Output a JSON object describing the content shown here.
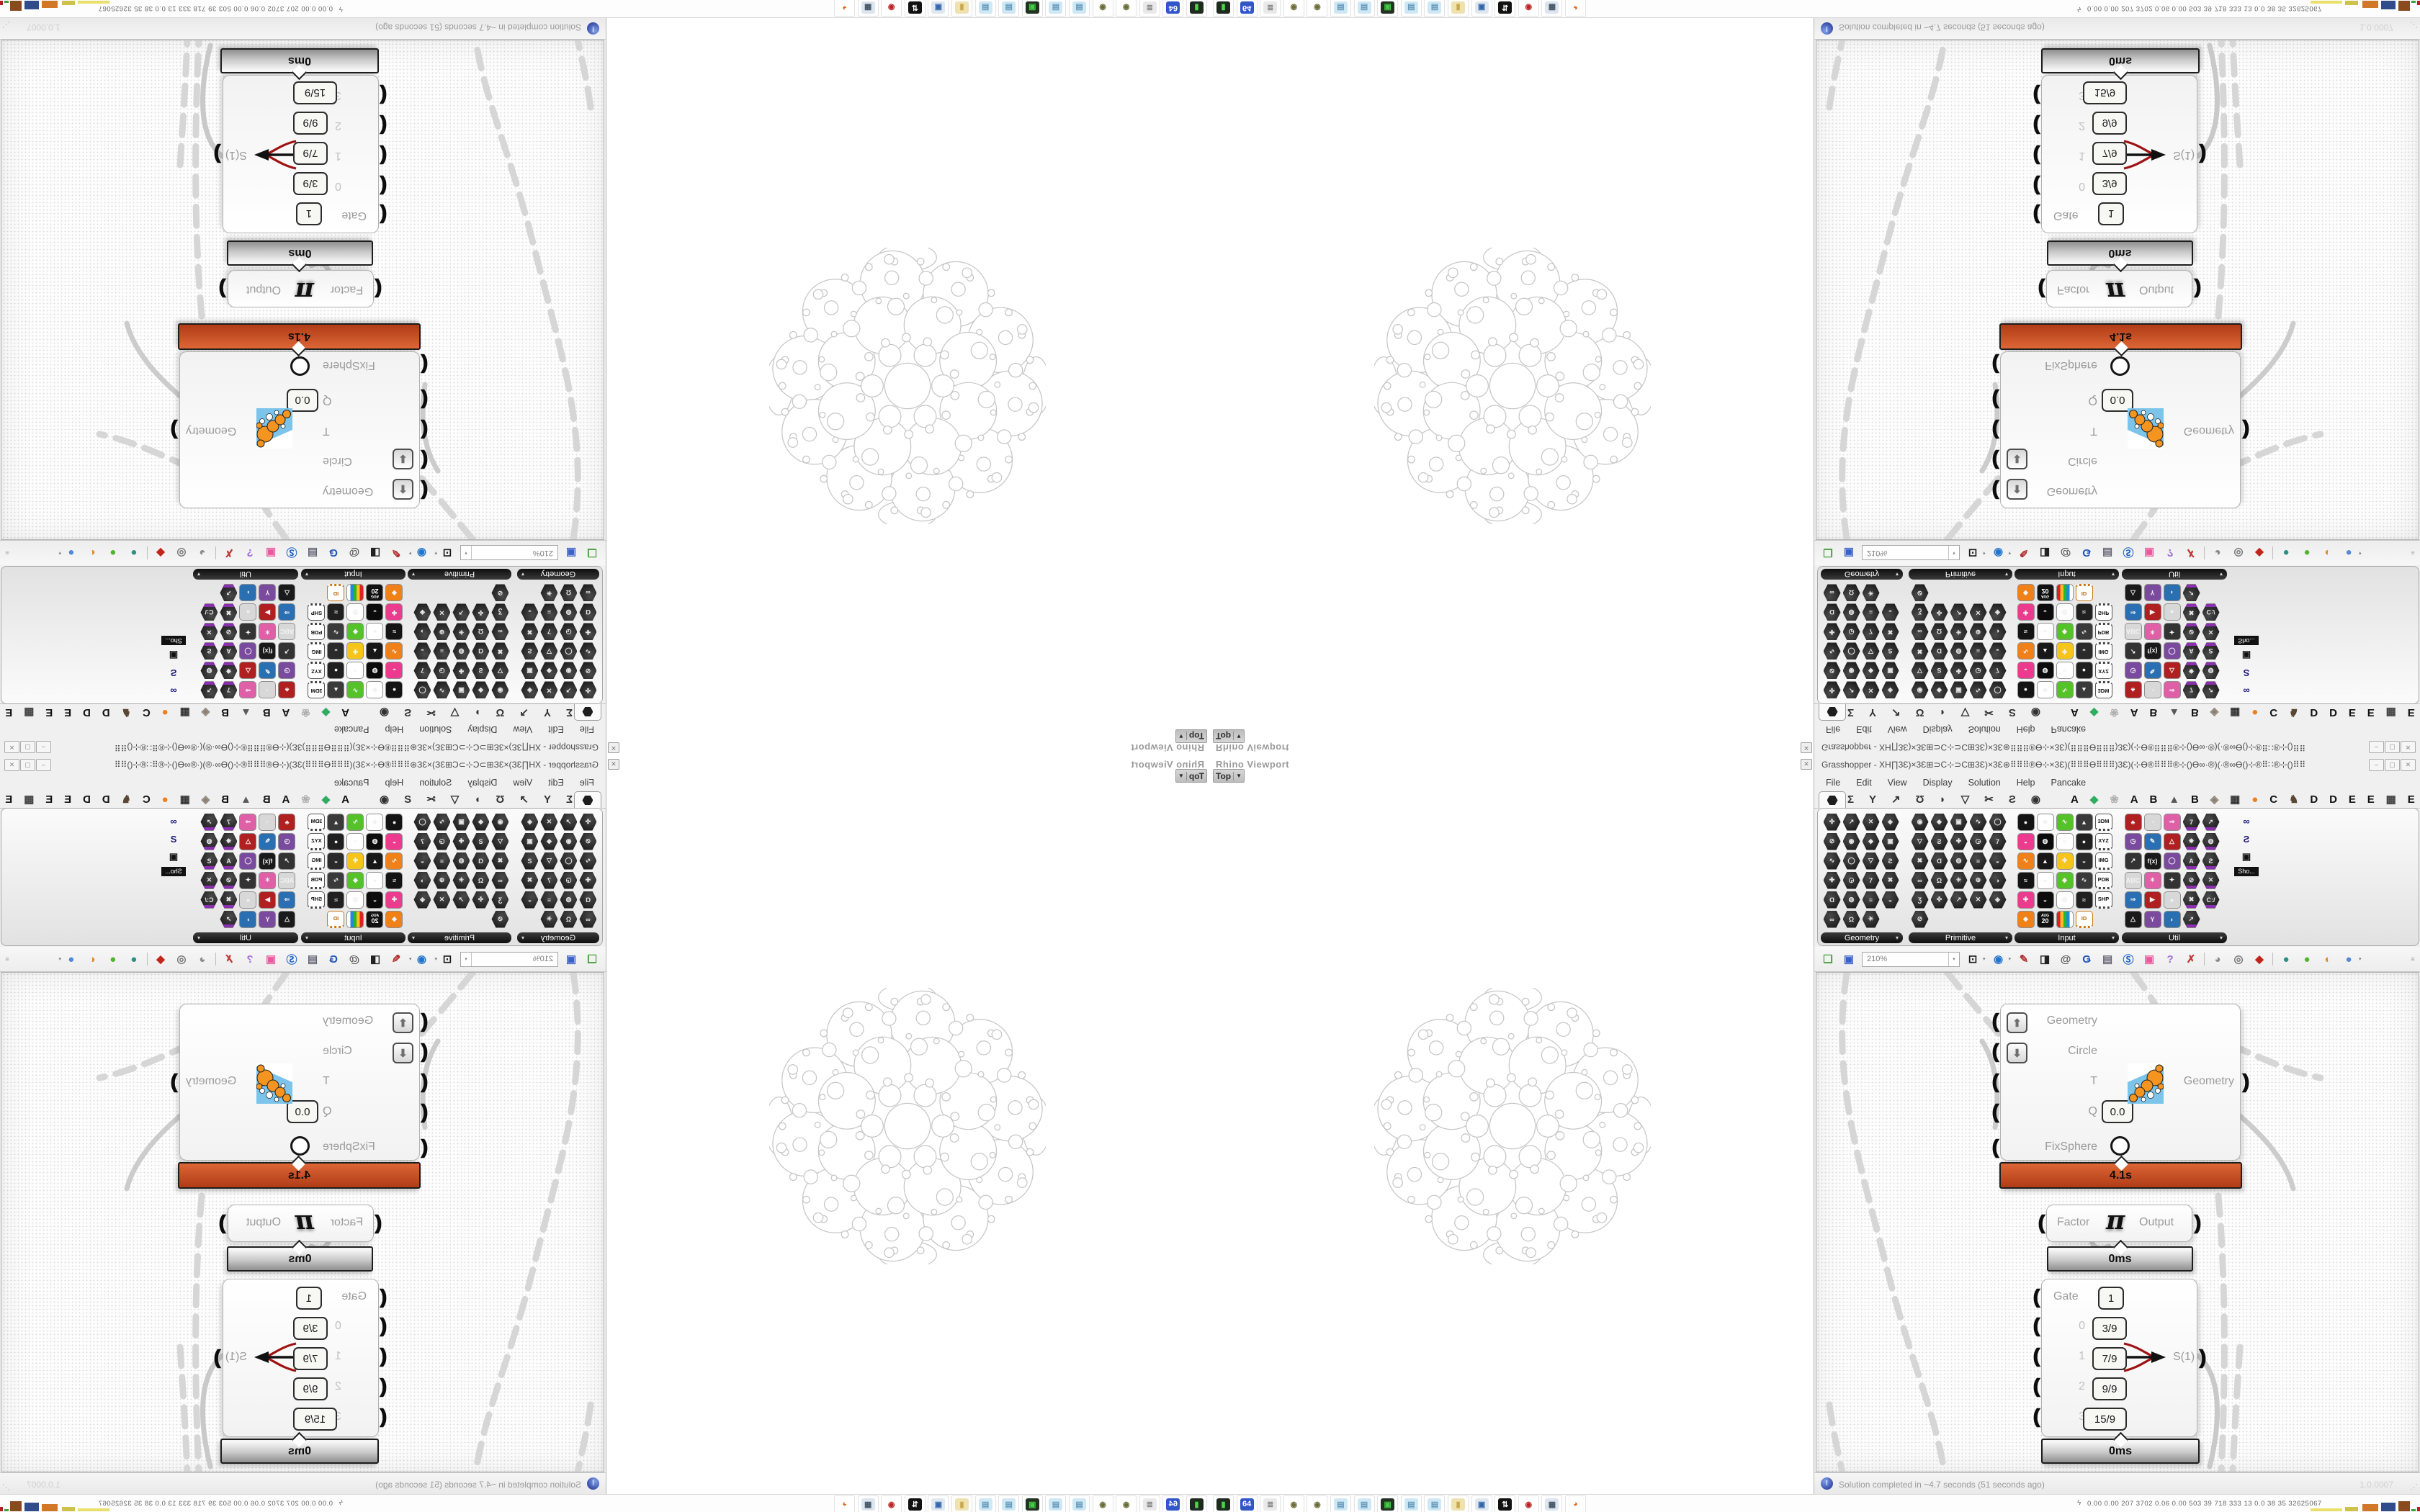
{
  "viewport": {
    "title": "Rhino Viewport",
    "view_button": "Top",
    "close_glyph": "✕"
  },
  "window": {
    "title": "Grasshopper - XH∏3Ɛ)×3Ɛ⊞⊃C⊹⊃C⊞3Ɛ)×3Ɛ⊛⠿⠿⠿®Ɵ⊹×3Ɛ)(⠿⠿⠿Ɵ⠿⠿⠿)3Ɛ)(⊹Ɵ®⠿⠿⠿®⊹()Ɵ∞·®)(·®∞Ɵ()⊹®⠿∷®⊹()⠿⠿",
    "window_buttons": {
      "minimize": "‒",
      "maximize": "▢",
      "close": "✕"
    },
    "menu": [
      "File",
      "Edit",
      "View",
      "Display",
      "Solution",
      "Help",
      "Pancake"
    ],
    "tab_icons": [
      "Σ",
      "Y",
      "↗",
      "Ʊ",
      "◗",
      "▽",
      "✂",
      "Ƨ",
      "◉"
    ],
    "tab_letters": [
      {
        "g": "A",
        "c": "#111111"
      },
      {
        "g": "◆",
        "c": "#2fae62"
      },
      {
        "g": "❀",
        "c": "#b0b0b0"
      },
      {
        "g": "A",
        "c": "#111111"
      },
      {
        "g": "B",
        "c": "#111111"
      },
      {
        "g": "▲",
        "c": "#5a5a5a"
      },
      {
        "g": "B",
        "c": "#111111"
      },
      {
        "g": "◈",
        "c": "#8a7f72"
      },
      {
        "g": "▦",
        "c": "#333333"
      },
      {
        "g": "●",
        "c": "#ef7f1a"
      },
      {
        "g": "C",
        "c": "#111111"
      },
      {
        "g": "♞",
        "c": "#5a4733"
      },
      {
        "g": "D",
        "c": "#111111"
      },
      {
        "g": "D",
        "c": "#111111"
      },
      {
        "g": "E",
        "c": "#111111"
      },
      {
        "g": "E",
        "c": "#111111"
      },
      {
        "g": "▩",
        "c": "#444444"
      },
      {
        "g": "E",
        "c": "#111111"
      }
    ],
    "panels": [
      {
        "label": "Geometry",
        "cols": 4,
        "count": 23,
        "style": "dark"
      },
      {
        "label": "Primitive",
        "cols": 5,
        "count": 26,
        "style": "dark"
      },
      {
        "label": "Input",
        "cols": 5,
        "count": 29,
        "style": "color"
      },
      {
        "label": "Util",
        "cols": 5,
        "count": 29,
        "style": "mixed"
      }
    ],
    "input_badges": [
      "3DM",
      "XYZ",
      "IMG",
      "PDB",
      "SHP",
      "ID"
    ],
    "calendar_badge": {
      "top": "AUG",
      "bottom": "20"
    },
    "util_texts": [
      "C:/",
      "A",
      "REC",
      "7",
      "f(x)",
      "Pr",
      "0.1",
      "ABC"
    ],
    "panel_overflow_label": "Sho...",
    "toolbar": {
      "zoom": "210%"
    },
    "canvas": {
      "node_fixsphere": {
        "inputs": [
          "Geometry",
          "Circle",
          "T",
          "Q",
          "FixSphere"
        ],
        "q_value": "0.0",
        "output": "Geometry",
        "time": "4.1s"
      },
      "node_pi": {
        "input": "Factor",
        "symbol": "π",
        "output": "Output",
        "time": "0ms"
      },
      "node_gate": {
        "gate_label": "Gate",
        "gate_value": "1",
        "rows": [
          {
            "index": "0",
            "value": "3/9"
          },
          {
            "index": "1",
            "value": "7/9"
          },
          {
            "index": "2",
            "value": "9/9"
          },
          {
            "index": "3",
            "value": "15/9"
          }
        ],
        "active_row": "1",
        "output": "S(1)",
        "time": "0ms"
      }
    },
    "statusbar": {
      "text": "Solution completed in ~4.7 seconds (51 seconds ago)",
      "version": "1.0.0007"
    }
  },
  "taskbar": {
    "icons": [
      {
        "name": "console",
        "g": "▮",
        "bg": "#1f2a1f",
        "fg": "#43d943"
      },
      {
        "name": "floppy-64",
        "g": "64",
        "bg": "#3355cc",
        "fg": "#ffffff"
      },
      {
        "name": "scroll-document",
        "g": "≣",
        "bg": "#e9e9e9",
        "fg": "#8a8a8a"
      },
      {
        "name": "coin-a",
        "g": "◉",
        "bg": "#ffffff",
        "fg": "#6b6b35"
      },
      {
        "name": "coin-b",
        "g": "◉",
        "bg": "#ffffff",
        "fg": "#6b6b35"
      },
      {
        "name": "notepad-a",
        "g": "▤",
        "bg": "#cfe8f5",
        "fg": "#6699bb"
      },
      {
        "name": "notepad-b",
        "g": "▤",
        "bg": "#cfe8f5",
        "fg": "#6699bb"
      },
      {
        "name": "media-monitor",
        "g": "▣",
        "bg": "#223322",
        "fg": "#44cc44"
      },
      {
        "name": "notepad-c",
        "g": "▤",
        "bg": "#cfe8f5",
        "fg": "#6699bb"
      },
      {
        "name": "notepad-d",
        "g": "▤",
        "bg": "#cfe8f5",
        "fg": "#6699bb"
      },
      {
        "name": "folder",
        "g": "▮",
        "bg": "#efe2b0",
        "fg": "#c9a94e"
      },
      {
        "name": "workstation",
        "g": "▣",
        "bg": "#dfe8f0",
        "fg": "#3366aa"
      },
      {
        "name": "arrows-bw",
        "g": "⇅",
        "bg": "#111111",
        "fg": "#ffffff"
      },
      {
        "name": "red-badge",
        "g": "◉",
        "bg": "#ffffff",
        "fg": "#bb2222"
      },
      {
        "name": "calculator",
        "g": "▦",
        "bg": "#dde6ee",
        "fg": "#445566"
      },
      {
        "name": "firefox",
        "g": "◕",
        "bg": "#ffffff",
        "fg": "#e8691c"
      }
    ],
    "stats": "0.00 0.00  207 3702 0.06 0.00  503   39   718  333   13   0.0   38   35  32625067"
  }
}
